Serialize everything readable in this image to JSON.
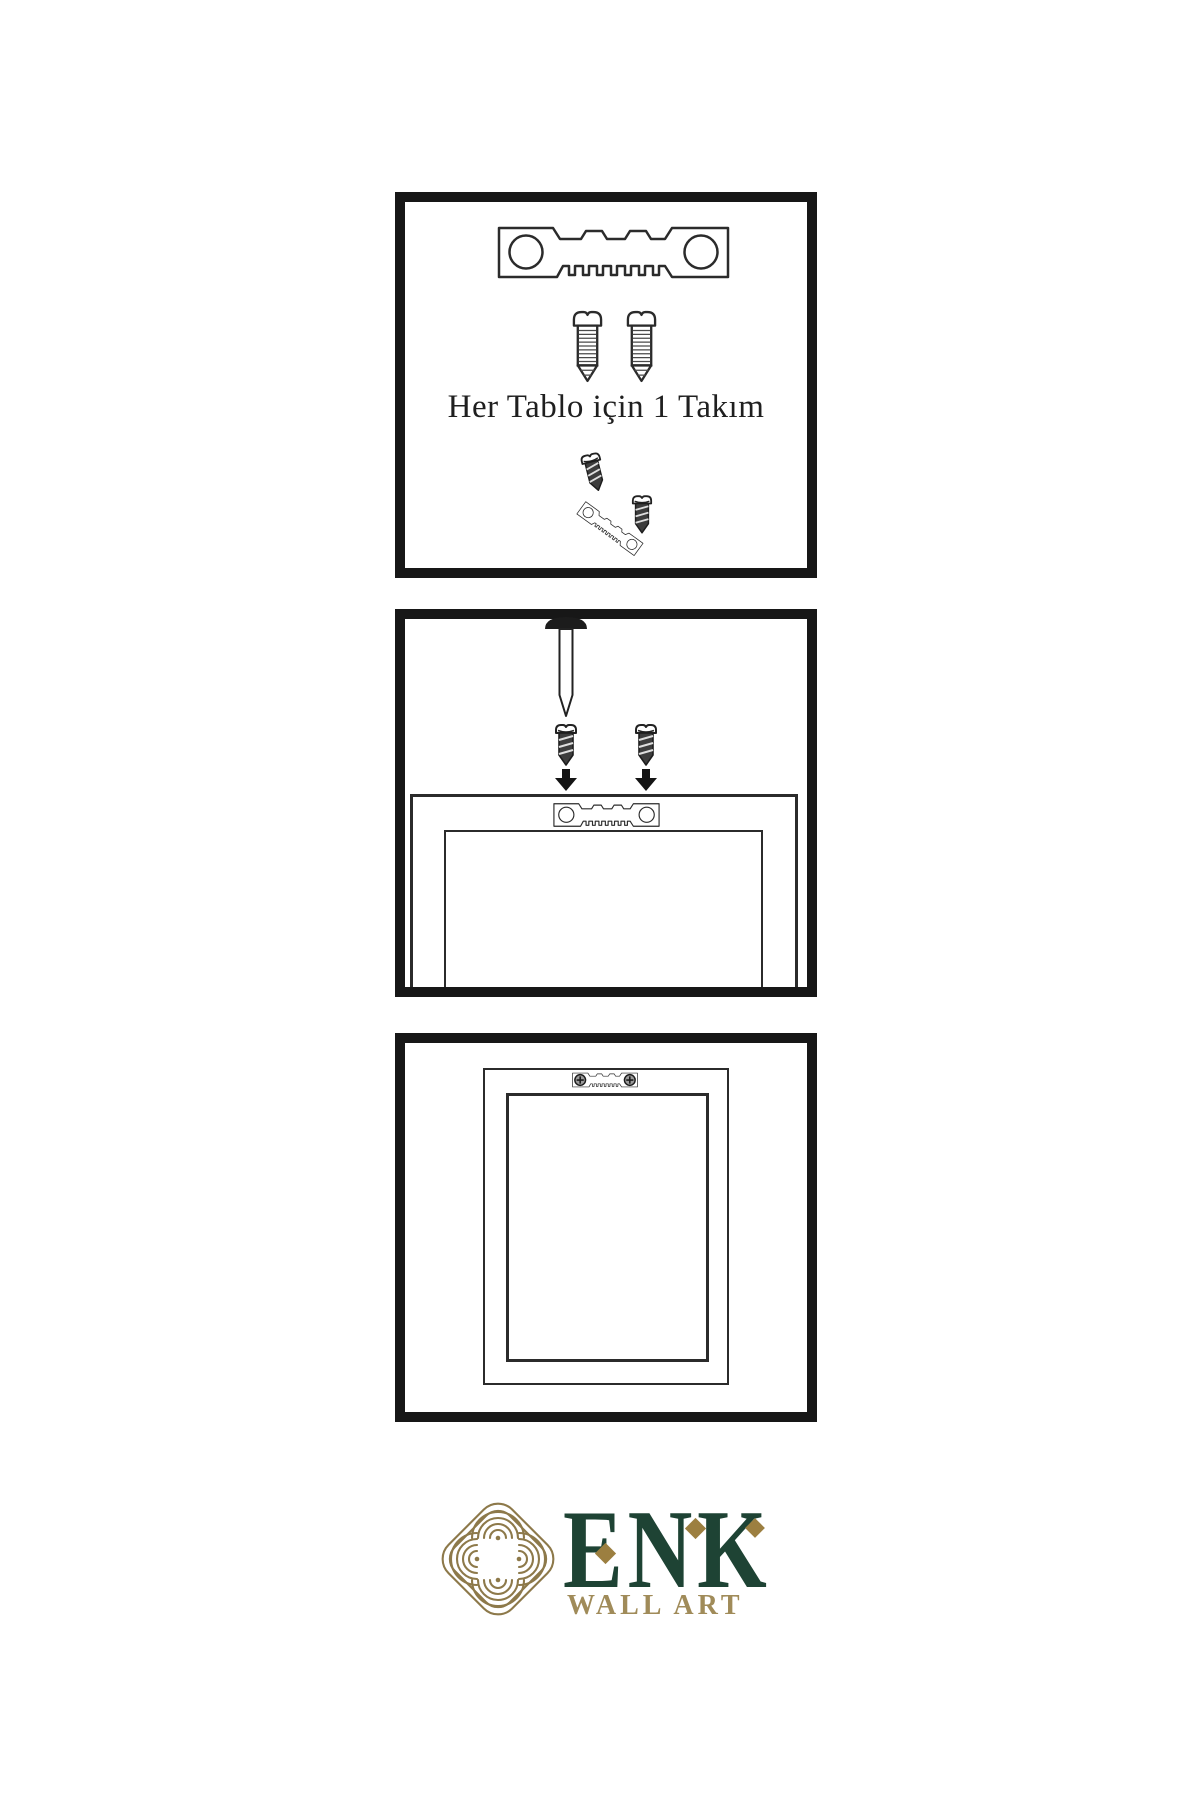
{
  "sheet": {
    "background": "#ffffff",
    "caption": "Her Tablo için 1 Takım",
    "caption_color": "#1f1f1f",
    "line_color": "#2b2b2b",
    "panel_border_color": "#171717"
  },
  "logo": {
    "brand": "ENK",
    "subtitle": "WALL ART",
    "knot_color": "#8d794a",
    "brand_color": "#1e4334",
    "subtitle_color": "#a08b59",
    "diamond_color": "#9c7f40"
  },
  "icons": {
    "hanger": "sawtooth-hanger",
    "screw_white": "screw-side-view",
    "screw_dark": "screw-dark",
    "nail": "wall-nail",
    "arrow": "arrow-down",
    "phillips": "phillips-screw-head",
    "knot": "interlaced-knot"
  }
}
